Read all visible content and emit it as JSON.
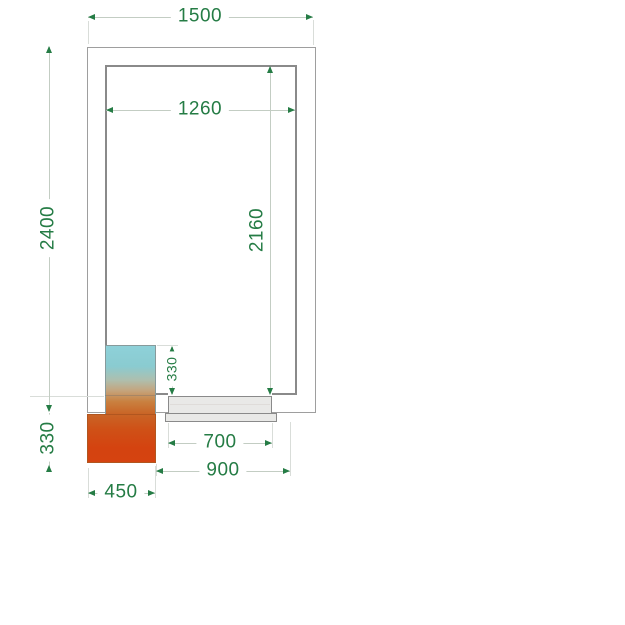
{
  "drawing": {
    "description": "Cold room plan view technical drawing with cooling unit and door",
    "background": "#ffffff"
  },
  "colors": {
    "dimension_text": "#257c45",
    "dimension_line": "#c3cdc3",
    "extension_line": "#d9ddd9",
    "outer_wall_line": "#9e9e9e",
    "inner_wall_line": "#8a8a8a",
    "door_fill": "#e9e9e7",
    "door_line": "#8a8a8a",
    "unit_cold_side": "#8ed1d9",
    "unit_hot_side": "#d54310"
  },
  "dimensions": {
    "overall_width": {
      "value": "1500"
    },
    "inner_width": {
      "value": "1260"
    },
    "overall_depth": {
      "value": "2400"
    },
    "inner_depth": {
      "value": "2160"
    },
    "unit_inner_protrusion": {
      "value": "330"
    },
    "unit_outer_protrusion": {
      "value": "330"
    },
    "door_clear_width": {
      "value": "700"
    },
    "door_overall_width": {
      "value": "900"
    },
    "unit_width": {
      "value": "450"
    }
  }
}
